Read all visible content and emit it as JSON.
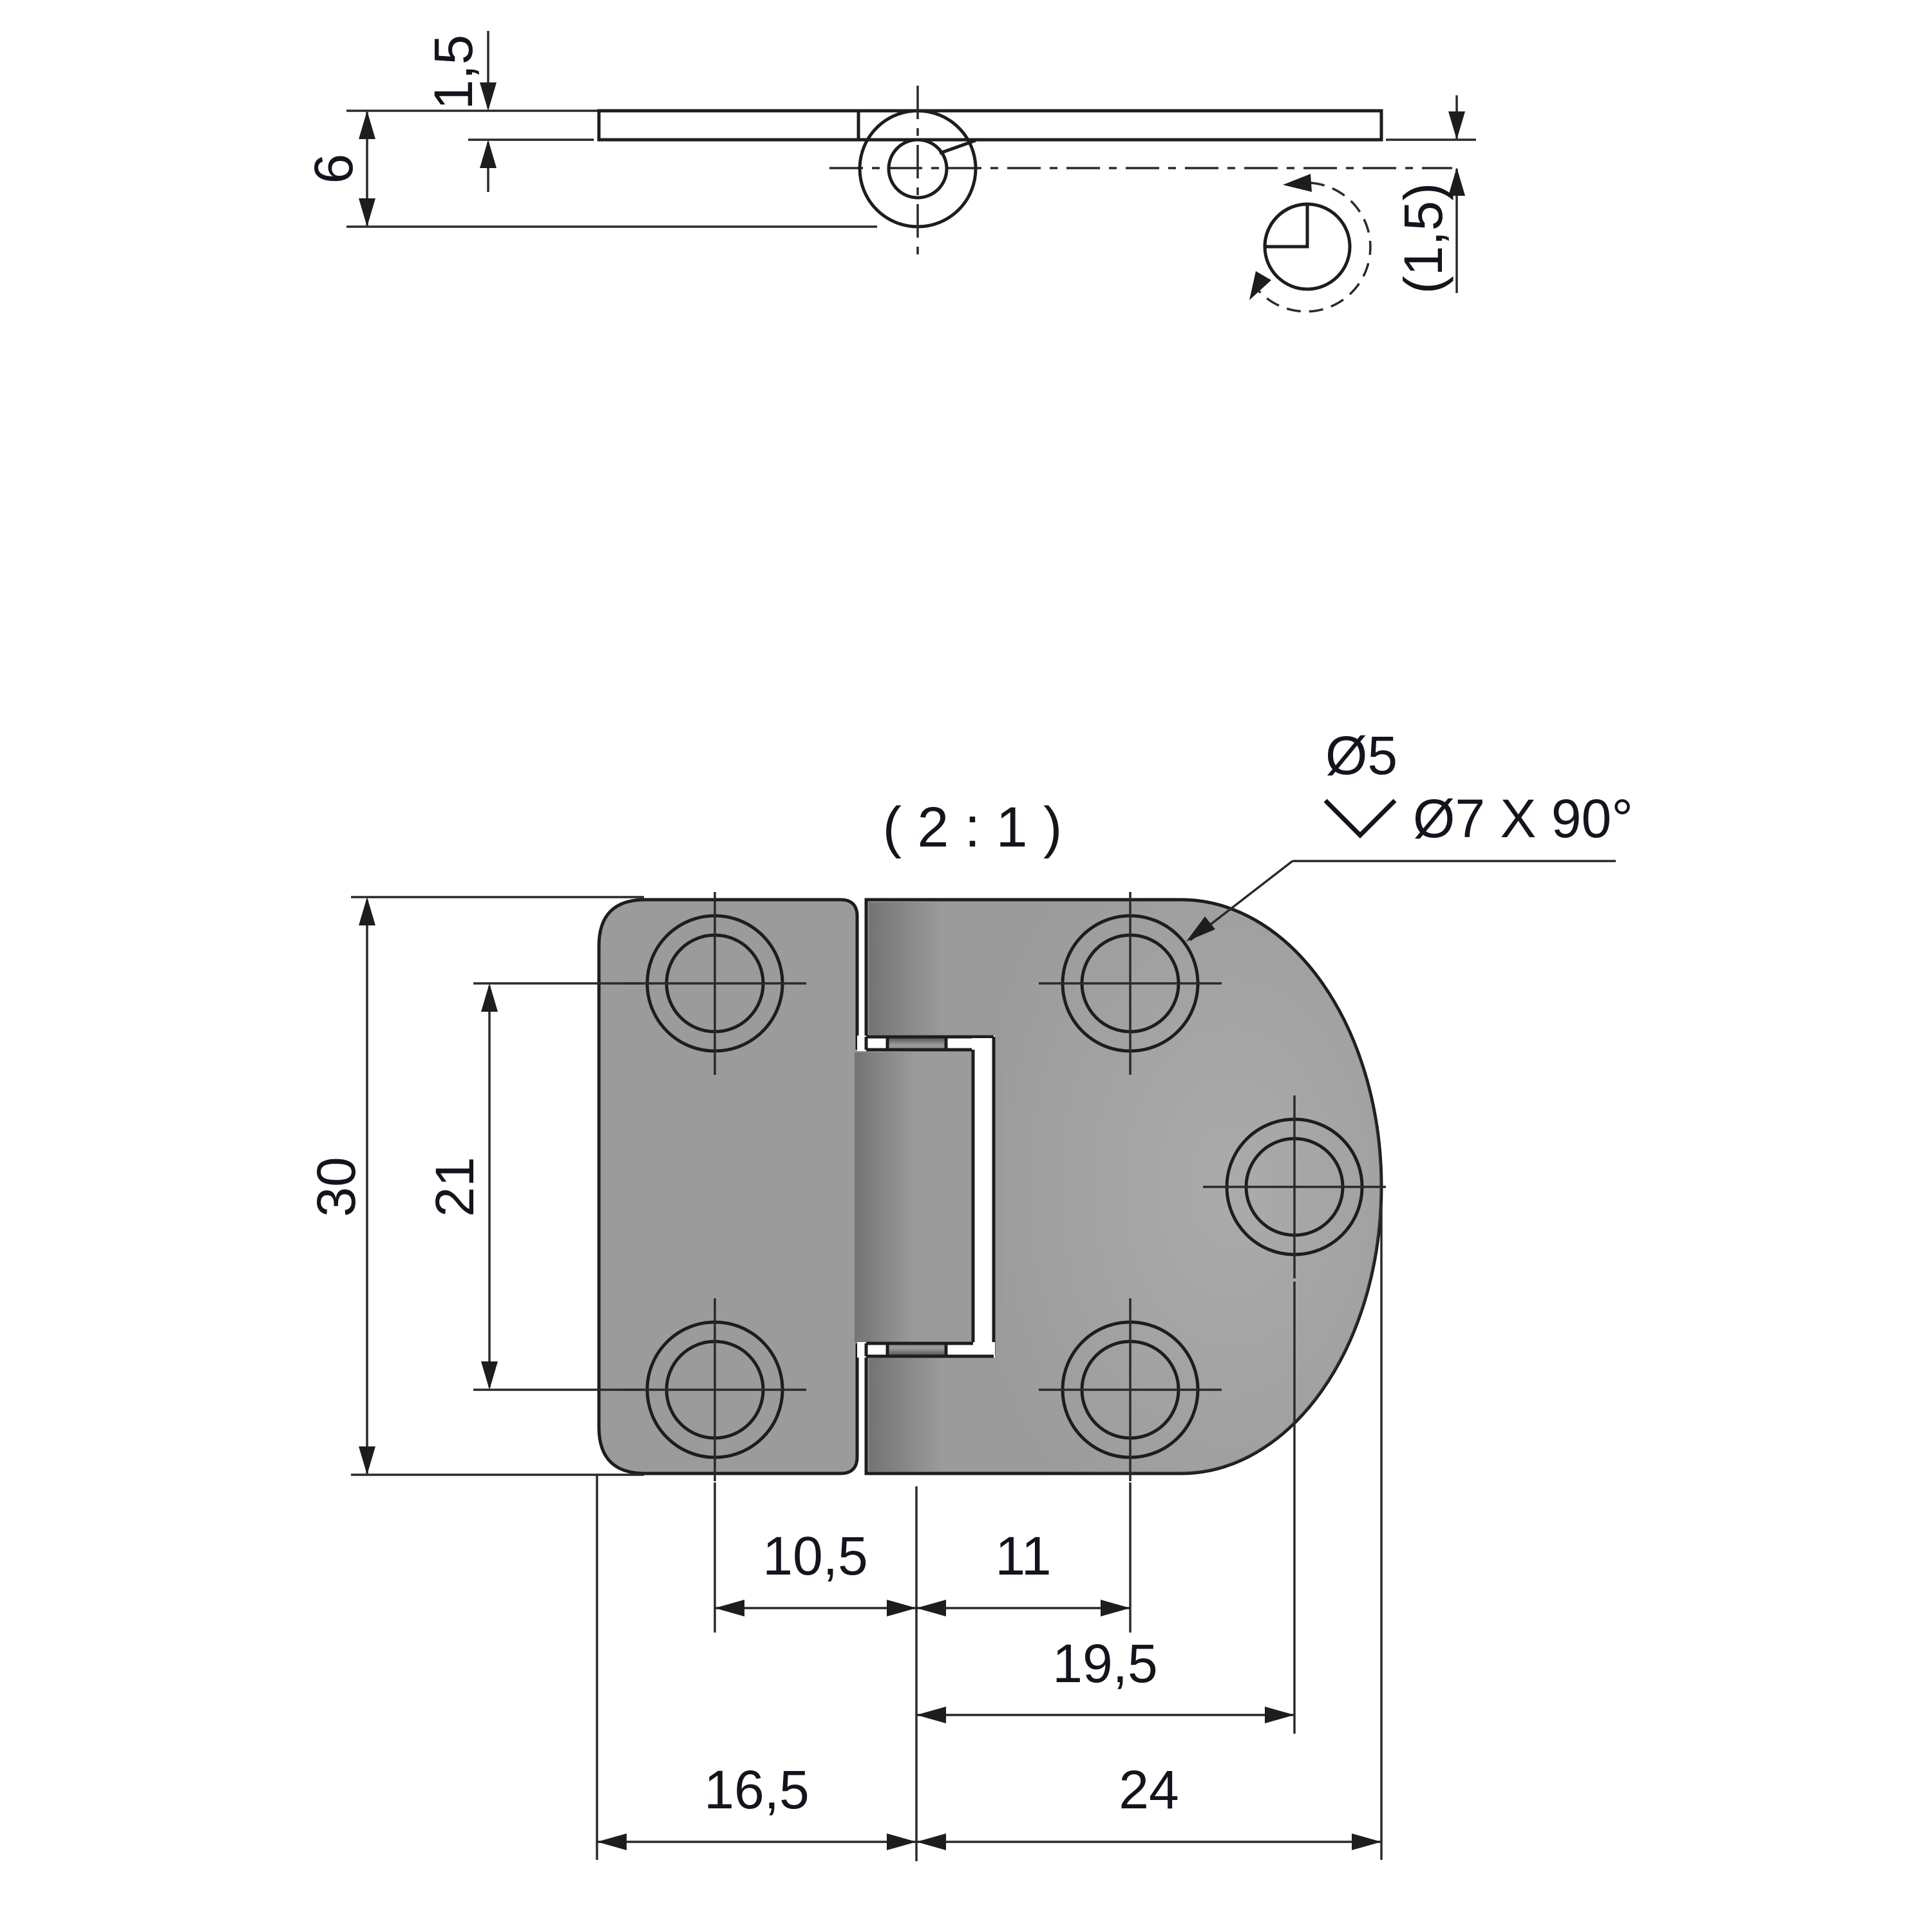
{
  "document": {
    "type": "engineering-drawing",
    "subject": "surface-mount hinge, two leaves with countersunk holes",
    "background": "#ffffff"
  },
  "colors": {
    "part_fill": "#9b9b9b",
    "part_outline": "#1d1d1d",
    "dimension_lines": "#2a2a2a",
    "text": "#14141c",
    "countersink_dark": "#474747",
    "countersink_light": "#dcdcdc"
  },
  "labels": {
    "scale": "( 2 : 1 )",
    "callout_dia": "Ø5",
    "callout_csk": "Ø7 X 90°",
    "side_thickness": "1,5",
    "side_height": "6",
    "side_pin_offset": "(1,5)",
    "plan_height": "30",
    "plan_hole_spacing": "21",
    "plan_left_holes_to_axis": "10,5",
    "plan_axis_to_right_holes": "11",
    "plan_axis_to_side_hole": "19,5",
    "plan_left_edge_to_axis": "16,5",
    "plan_axis_to_right_edge": "24"
  }
}
